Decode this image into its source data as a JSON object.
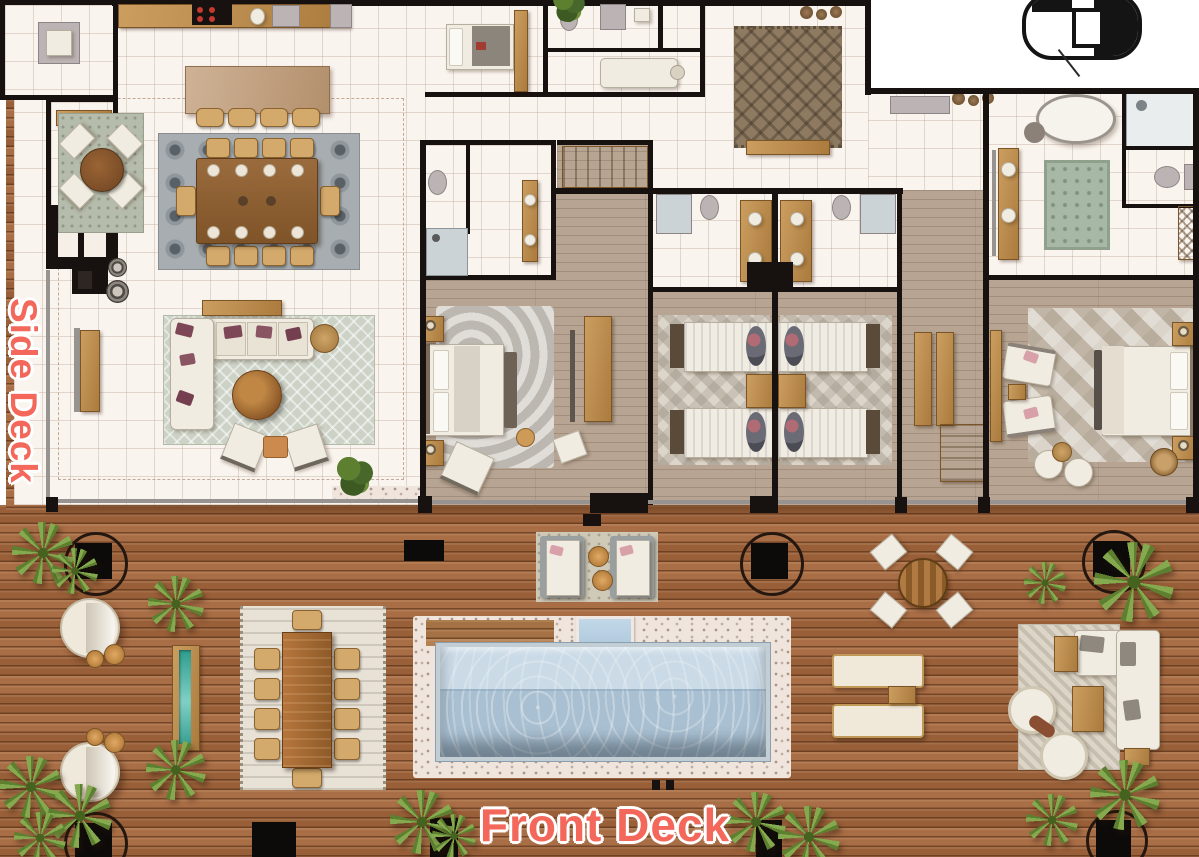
{
  "title": "Villa floor plan with pool decks",
  "labels": {
    "side_deck": "Side Deck",
    "front_deck": "Front Deck"
  },
  "colors": {
    "label_text": "#f4685c",
    "label_outline": "#ffffff",
    "deck_wood": "#a4663c",
    "deck_groove": "#4a2610",
    "interior_tile": "#faf4ee",
    "bedroom_wood": "#b7a492",
    "wall": "#171110",
    "pool_water": "#a9c0d2",
    "pool_coping": "#c3cdd4",
    "pebble_border": "#efe5dc",
    "palm_green": "#85a94e",
    "living_rug": "#ccd3c6",
    "dining_rug": "#a7adb0",
    "foyer_rug": "#8d7a61",
    "bath_rug_green": "#a8b8a6",
    "water_feature": "#2e9c8e"
  },
  "areas": [
    {
      "name": "kitchen"
    },
    {
      "name": "dining-area"
    },
    {
      "name": "breakfast-nook"
    },
    {
      "name": "living-room"
    },
    {
      "name": "entry-foyer"
    },
    {
      "name": "staff-room"
    },
    {
      "name": "guest-bedroom"
    },
    {
      "name": "twin-bedroom-left"
    },
    {
      "name": "twin-bedroom-right"
    },
    {
      "name": "master-bedroom"
    },
    {
      "name": "master-bathroom"
    },
    {
      "name": "guest-bathrooms"
    },
    {
      "name": "side-deck"
    },
    {
      "name": "front-deck"
    },
    {
      "name": "swimming-pool"
    },
    {
      "name": "spa"
    },
    {
      "name": "outdoor-dining"
    },
    {
      "name": "outdoor-lounge"
    },
    {
      "name": "sun-loungers"
    },
    {
      "name": "round-daybeds"
    },
    {
      "name": "water-feature"
    },
    {
      "name": "elevator"
    }
  ]
}
